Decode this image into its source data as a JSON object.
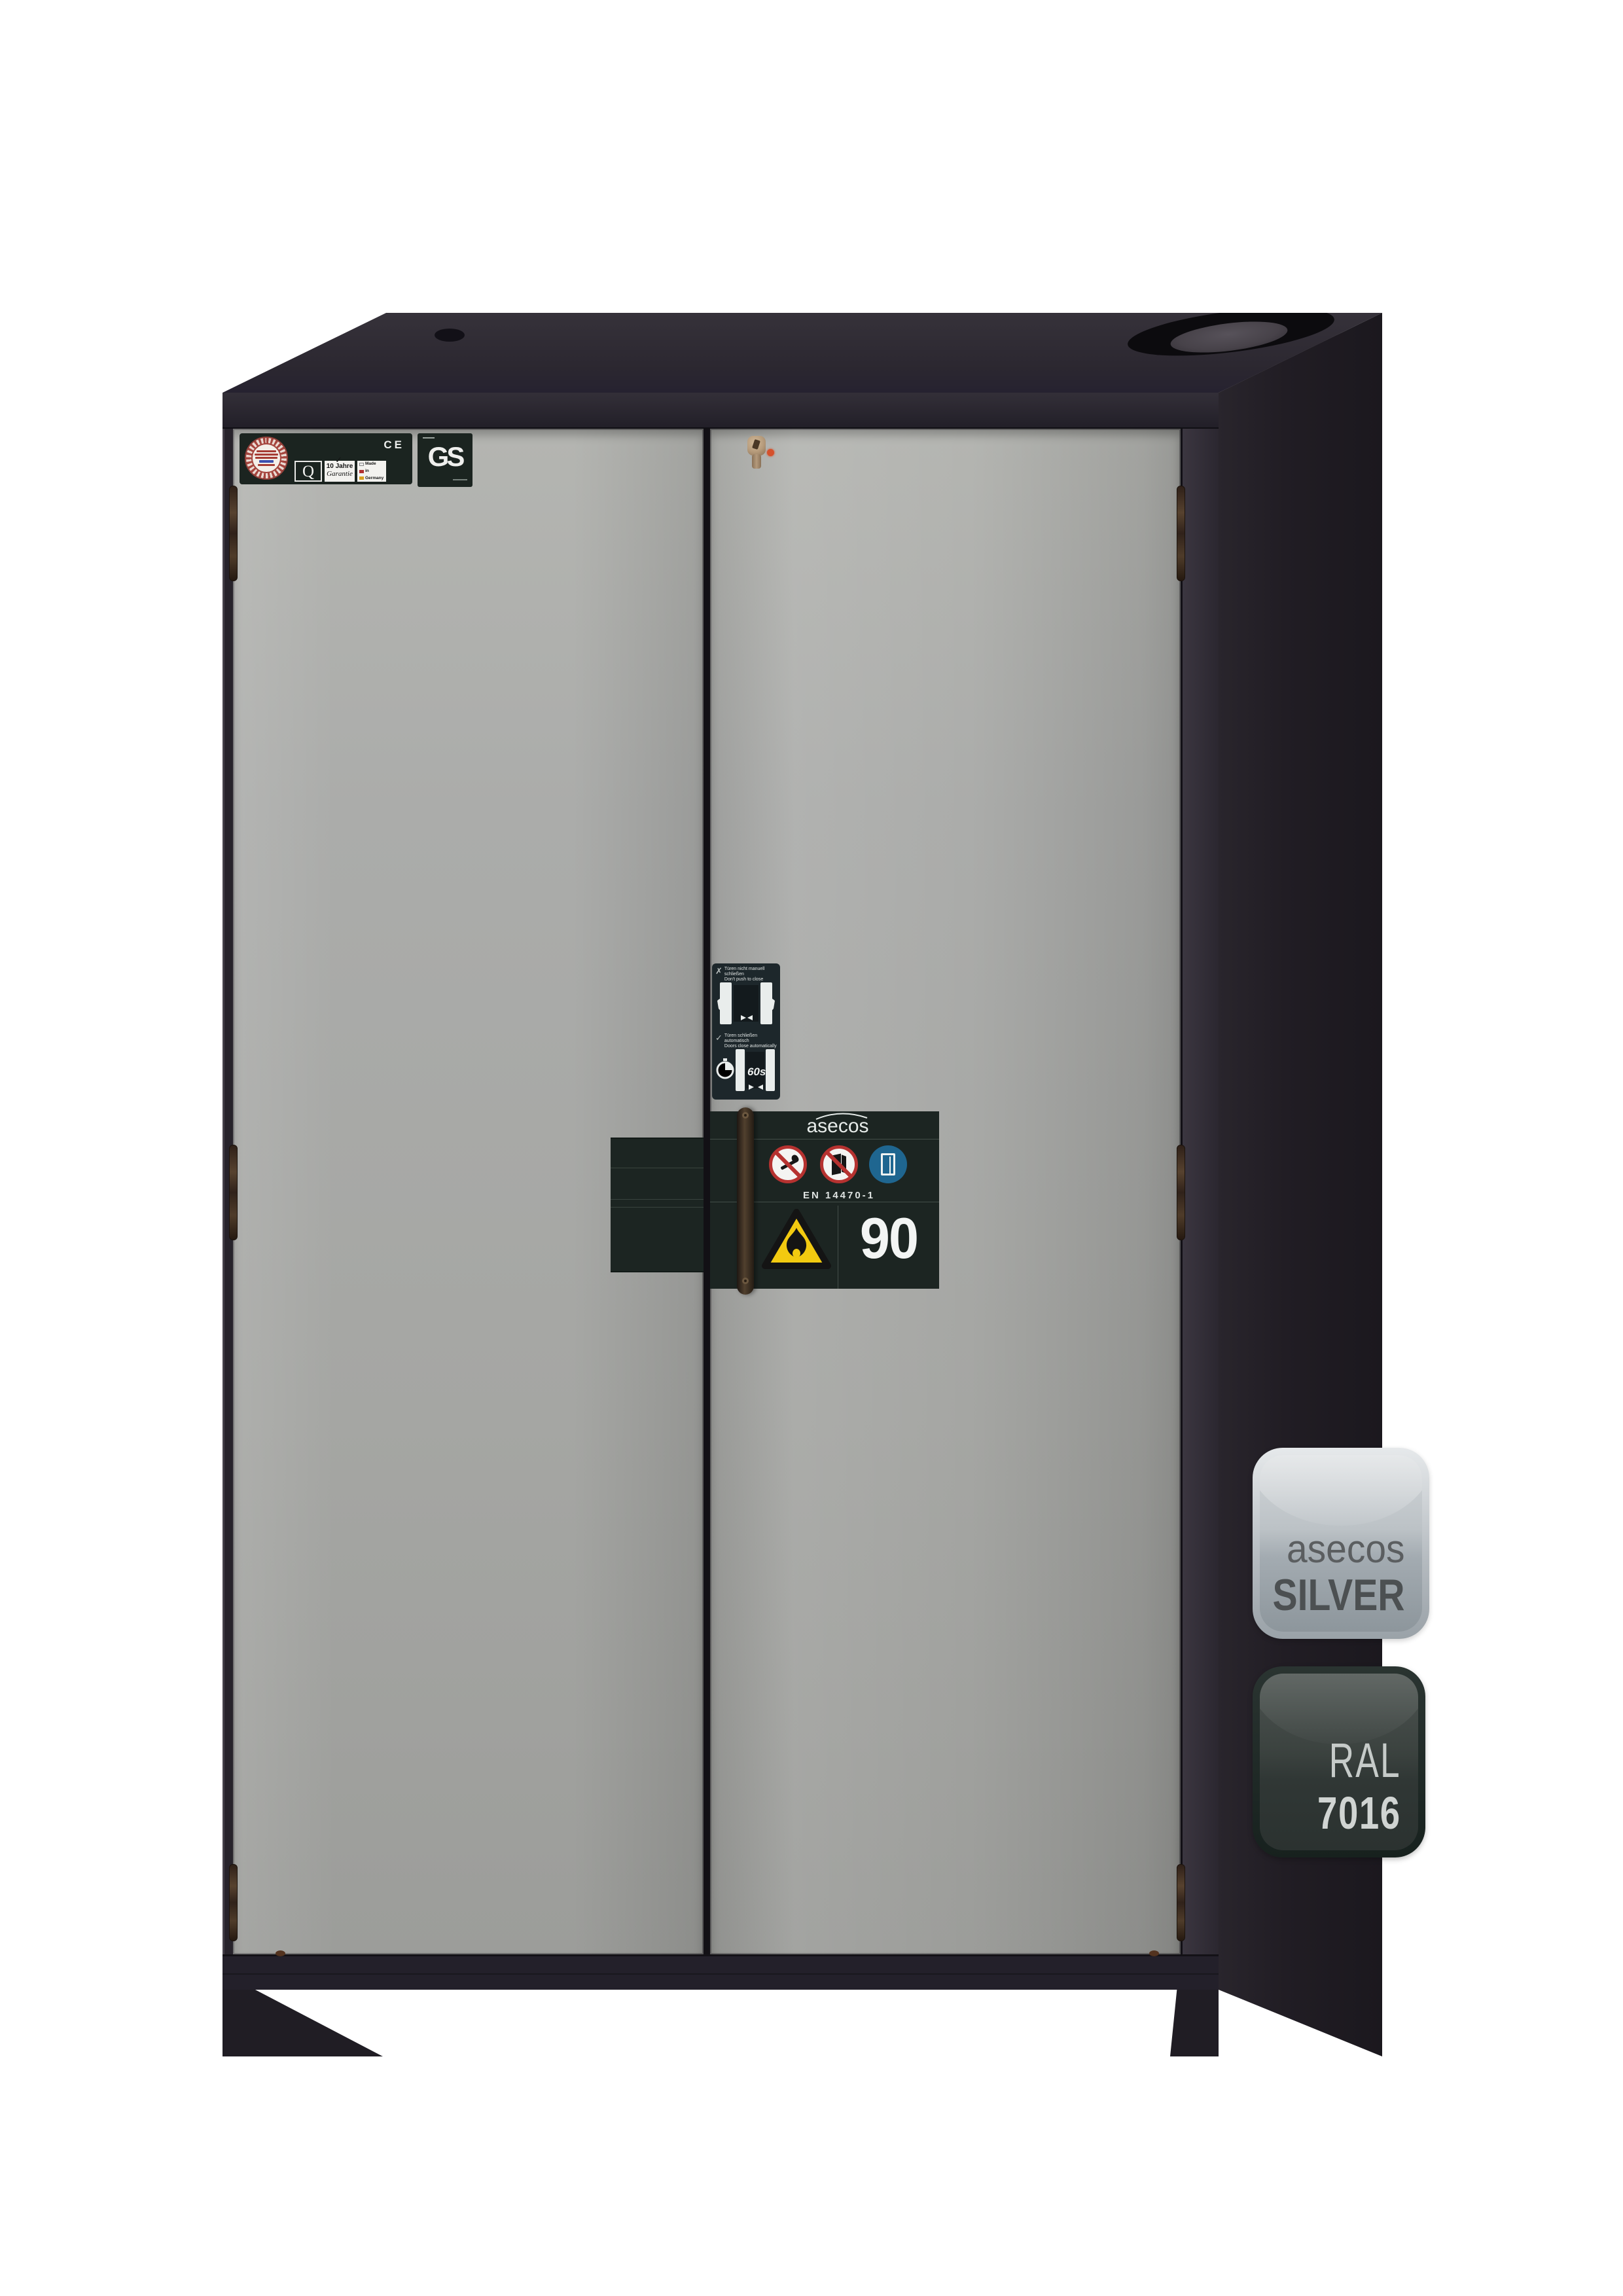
{
  "cabinet": {
    "certification": {
      "q": "Q",
      "warranty_top": "10 Jahre",
      "warranty_bottom": "Garantie",
      "warranty_check": "✓",
      "made_in": [
        "Made",
        "in",
        "Germany"
      ],
      "ce": "CE",
      "gs": "GS"
    },
    "door_sticker": {
      "no_push_mark": "✗",
      "no_push_de": "Türen nicht manuell schließen",
      "no_push_en": "Don't push to close",
      "auto_close_mark": "✓",
      "auto_close_de": "Türen schließen automatisch",
      "auto_close_en": "Doors close automatically",
      "timer": "60s"
    },
    "type_label": {
      "brand": "asecos",
      "norm": "EN 14470-1",
      "fire_rating": "90"
    }
  },
  "badges": {
    "silver": {
      "line1": "asecos",
      "line2": "SILVER"
    },
    "ral": {
      "line1": "RAL",
      "line2": "7016"
    }
  },
  "colors": {
    "background": "#ffffff",
    "body_anthracite_ral7016": "#27232b",
    "door_silver": "#a7a8a4",
    "label_background": "#1c2522",
    "prohibition_red": "#b63230",
    "mandatory_blue": "#1f6690",
    "warning_yellow": "#f2ca10",
    "led_red": "#d5512c",
    "silver_badge_text": "#4c5052",
    "ral_badge_text": "#d0d4d2"
  }
}
